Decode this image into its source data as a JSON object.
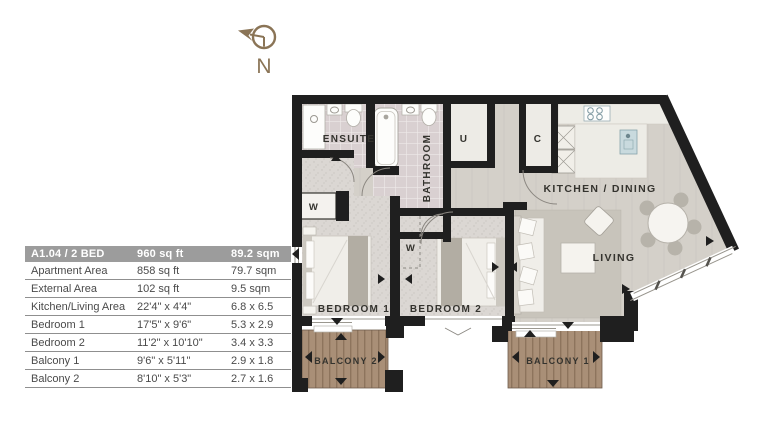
{
  "compass": {
    "label": "N"
  },
  "table": {
    "header": {
      "name": "A1.04 / 2 BED",
      "imperial": "960 sq ft",
      "metric": "89.2 sqm"
    },
    "rows": [
      {
        "label": "Apartment Area",
        "imperial": "858 sq ft",
        "metric": "79.7 sqm"
      },
      {
        "label": "External Area",
        "imperial": "102 sq ft",
        "metric": "9.5 sqm"
      },
      {
        "label": "Kitchen/Living Area",
        "imperial": "22'4\" x 4'4\"",
        "metric": "6.8 x 6.5"
      },
      {
        "label": "Bedroom 1",
        "imperial": "17'5\" x 9'6\"",
        "metric": "5.3 x 2.9"
      },
      {
        "label": "Bedroom 2",
        "imperial": "11'2\" x 10'10\"",
        "metric": "3.4 x 3.3"
      },
      {
        "label": "Balcony 1",
        "imperial": "9'6\" x 5'11\"",
        "metric": "2.9 x 1.8"
      },
      {
        "label": "Balcony 2",
        "imperial": "8'10\" x 5'3\"",
        "metric": "2.7 x 1.6"
      }
    ]
  },
  "plan": {
    "rooms": {
      "ensuite": "ENSUITE",
      "bathroom": "BATHROOM",
      "utility": "U",
      "cupboard": "C",
      "wardrobe1": "W",
      "wardrobe2": "W",
      "kitchen_dining": "KITCHEN / DINING",
      "living": "LIVING",
      "bedroom1": "BEDROOM 1",
      "bedroom2": "BEDROOM 2",
      "balcony1": "BALCONY 1",
      "balcony2": "BALCONY 2"
    }
  },
  "colors": {
    "wall": "#1f1f1f",
    "hard_floor": "#d4d0c9",
    "carpet": "#dbd7d3",
    "tile": "#d9d0d1",
    "rug": "#c8c4bb",
    "deck": "#a98f77",
    "table_header_bg": "#9c9c9c",
    "compass": "#8a7456"
  }
}
